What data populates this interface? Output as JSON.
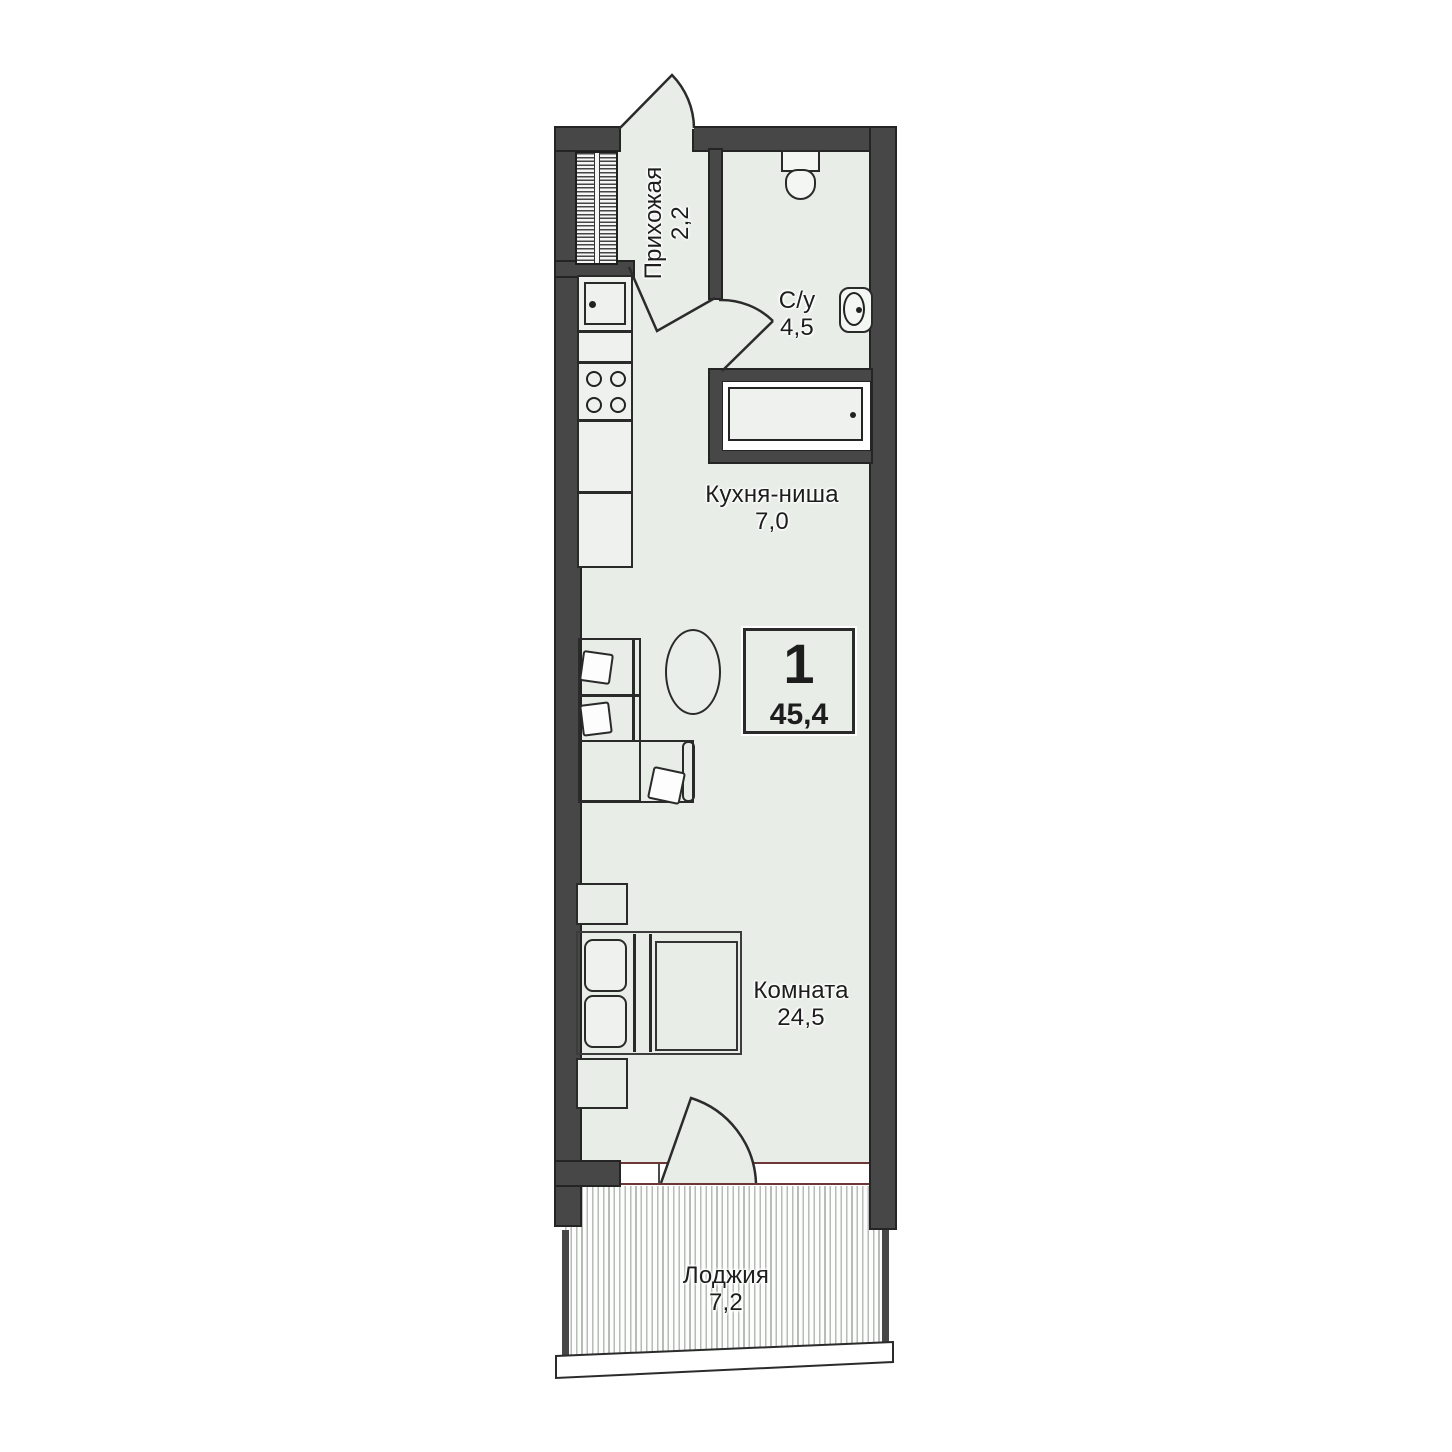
{
  "badge": {
    "rooms_count": "1",
    "total_area": "45,4"
  },
  "rooms": {
    "hallway": {
      "label": "Прихожая",
      "area": "2,2"
    },
    "bathroom": {
      "label": "С/у",
      "area": "4,5"
    },
    "kitchen": {
      "label": "Кухня-ниша",
      "area": "7,0"
    },
    "living": {
      "label": "Комната",
      "area": "24,5"
    },
    "loggia": {
      "label": "Лоджия",
      "area": "7,2"
    }
  },
  "colors": {
    "wall": "#474747",
    "wall_outline": "#242424",
    "floor": "#e8ede8",
    "line": "#2a2a2a",
    "window_frame": "#6e3737",
    "text": "#1d1d1d",
    "hatch": "#b7bcb7"
  }
}
